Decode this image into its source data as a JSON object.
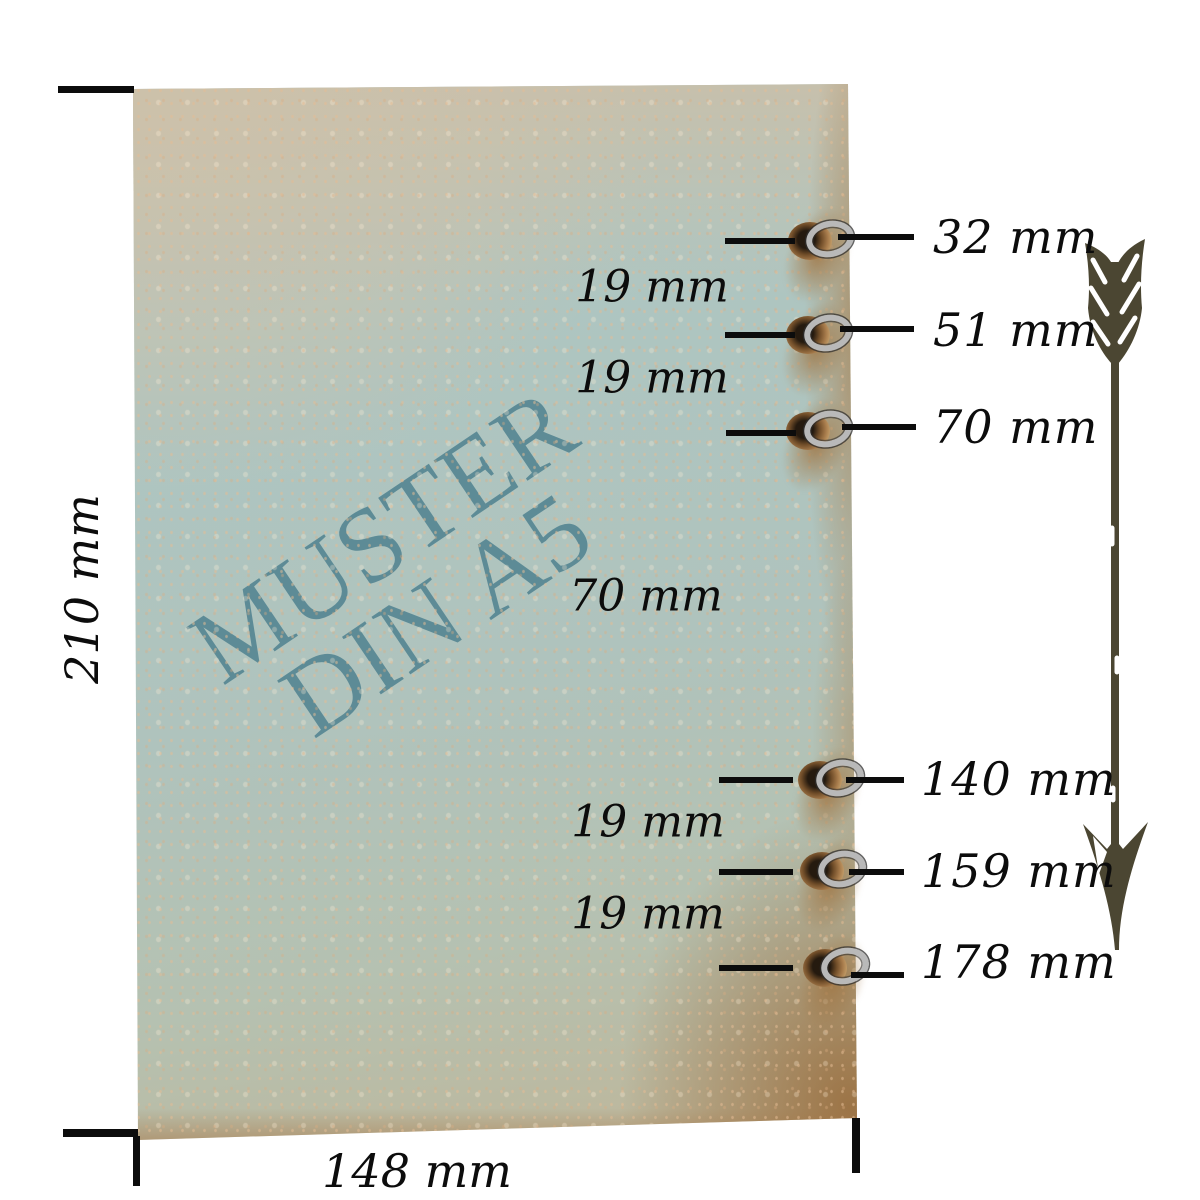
{
  "colors": {
    "watermark": "#5d8b96",
    "label_ink": "#0c0c0c",
    "arrow": "#4b4632",
    "cover_blue": "#aec6c2",
    "cover_tan": "#cdc2ab",
    "cover_edge_brown": "#9d7345",
    "eyelet_metal": "#b9b9b9"
  },
  "watermark": {
    "line1": "MUSTER",
    "line2": "DIN A5"
  },
  "dimensions": {
    "height": "210 mm",
    "width": "148 mm"
  },
  "holes": [
    {
      "label": "32 mm"
    },
    {
      "label": "51 mm"
    },
    {
      "label": "70 mm"
    },
    {
      "label": "140 mm"
    },
    {
      "label": "159 mm"
    },
    {
      "label": "178 mm"
    }
  ],
  "gaps": [
    {
      "label": "19 mm"
    },
    {
      "label": "19 mm"
    },
    {
      "label": "70 mm"
    },
    {
      "label": "19 mm"
    },
    {
      "label": "19 mm"
    }
  ],
  "icons": {
    "arrow": "down-arrow-icon"
  }
}
